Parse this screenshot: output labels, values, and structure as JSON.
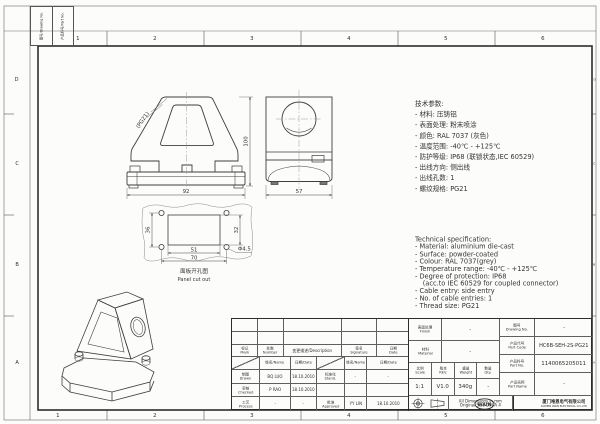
{
  "frame": {
    "zone_numbers": [
      "1",
      "2",
      "3",
      "4",
      "5",
      "6"
    ],
    "zone_letters": [
      "D",
      "C",
      "B",
      "A"
    ]
  },
  "corner_block": {
    "cell1": "图号/Drawing No.",
    "cell2": "产品料号/Part No."
  },
  "views": {
    "front": {
      "dim_height": "100",
      "dim_width": "92",
      "thread_label": "(PG21)"
    },
    "side": {
      "dim_width": "57"
    },
    "panel": {
      "dim_hole_spacing_v": "36",
      "dim_rect_height": "32",
      "dim_rect_width": "51",
      "dim_hole_spacing_h": "70",
      "hole_dia": "Φ4.5",
      "caption_cn": "面板开孔图",
      "caption_en": "Panel cut out"
    }
  },
  "spec_cn": {
    "title": "技术参数:",
    "lines": [
      "- 材料: 压铸铝",
      "- 表面处理: 粉末喷涂",
      "- 颜色: RAL 7037 (灰色)",
      "- 温度范围: -40℃ - +125℃",
      "- 防护等级: IP68 (联锁状态,IEC 60529)",
      "- 出线方向: 侧出线",
      "- 出线孔数: 1",
      "- 螺纹规格: PG21"
    ]
  },
  "spec_en": {
    "title": "Technical specification:",
    "lines": [
      "- Material: aluminium die-cast",
      "- Surface: powder-coated",
      "- Colour: RAL 7037(grey)",
      "- Temperature range: -40℃ - +125℃",
      "- Degree of protection: IP68",
      "(acc.to IEC 60529 for coupled connector)",
      "- Cable entry: side entry",
      "- No. of cable entries: 1",
      "- Thread size: PG21"
    ]
  },
  "title_block": {
    "rev_header": {
      "mark_cn": "标记",
      "mark_en": "Mark",
      "number_cn": "处数",
      "number_en": "Number",
      "desc": "变更描述/Description",
      "sig_cn": "签名",
      "sig_en": "Signature",
      "date_cn": "日期",
      "date_en": "Date"
    },
    "col_header": {
      "name": "姓名/Name",
      "date": "日期/Date"
    },
    "sign": {
      "drawn_cn": "制图",
      "drawn_en": "Drawn",
      "drawn_name": "BQ LUO",
      "drawn_date": "18.10.2010",
      "checked_cn": "审核",
      "checked_en": "Checked",
      "checked_name": "P RAO",
      "checked_date": "18.10.2010",
      "process_cn": "工艺",
      "process_en": "Process",
      "process_name": "-",
      "process_date": "-",
      "stand_cn": "标准化",
      "stand_en": "Stand.",
      "stand_name": "-",
      "stand_date": "-",
      "approved_cn": "批准",
      "approved_en": "Approved",
      "approved_name": "YY LIN",
      "approved_date": "18.10.2010"
    },
    "fields": {
      "finish_cn": "表面处理",
      "finish_en": "Finish",
      "finish_val": "-",
      "material_cn": "材料",
      "material_en": "Material",
      "material_val": "-",
      "dwg_cn": "图号",
      "dwg_en": "Drawing No.",
      "dwg_val": "-",
      "code_cn": "产品代号",
      "code_en": "Part Code",
      "code_val": "HC6B-SEH-2S-PG21",
      "pno_cn": "产品料号",
      "pno_en": "Part No.",
      "pno_val": "1140065205011",
      "pname_cn": "产品名称",
      "pname_en": "Part Name",
      "pname_val": "-",
      "scale_cn": "比例",
      "scale_en": "Scale",
      "scale_val": "1:1",
      "rev_cn": "版本",
      "rev_en": "REV.",
      "rev_val": "V1.0",
      "weight_cn": "重量",
      "weight_en": "Weight",
      "weight_val": "340g",
      "qty_cn": "数量",
      "qty_en": "Qty.",
      "qty_val": "-"
    },
    "footer": {
      "note1": "All Dimensions in mm",
      "note2": "Original Size DIN A 4",
      "logo": "WAIN",
      "company_cn": "厦门唯恩电气有限公司",
      "company_en": "XIAMEN WAIN ELECTRICAL CO.,LTD"
    }
  }
}
